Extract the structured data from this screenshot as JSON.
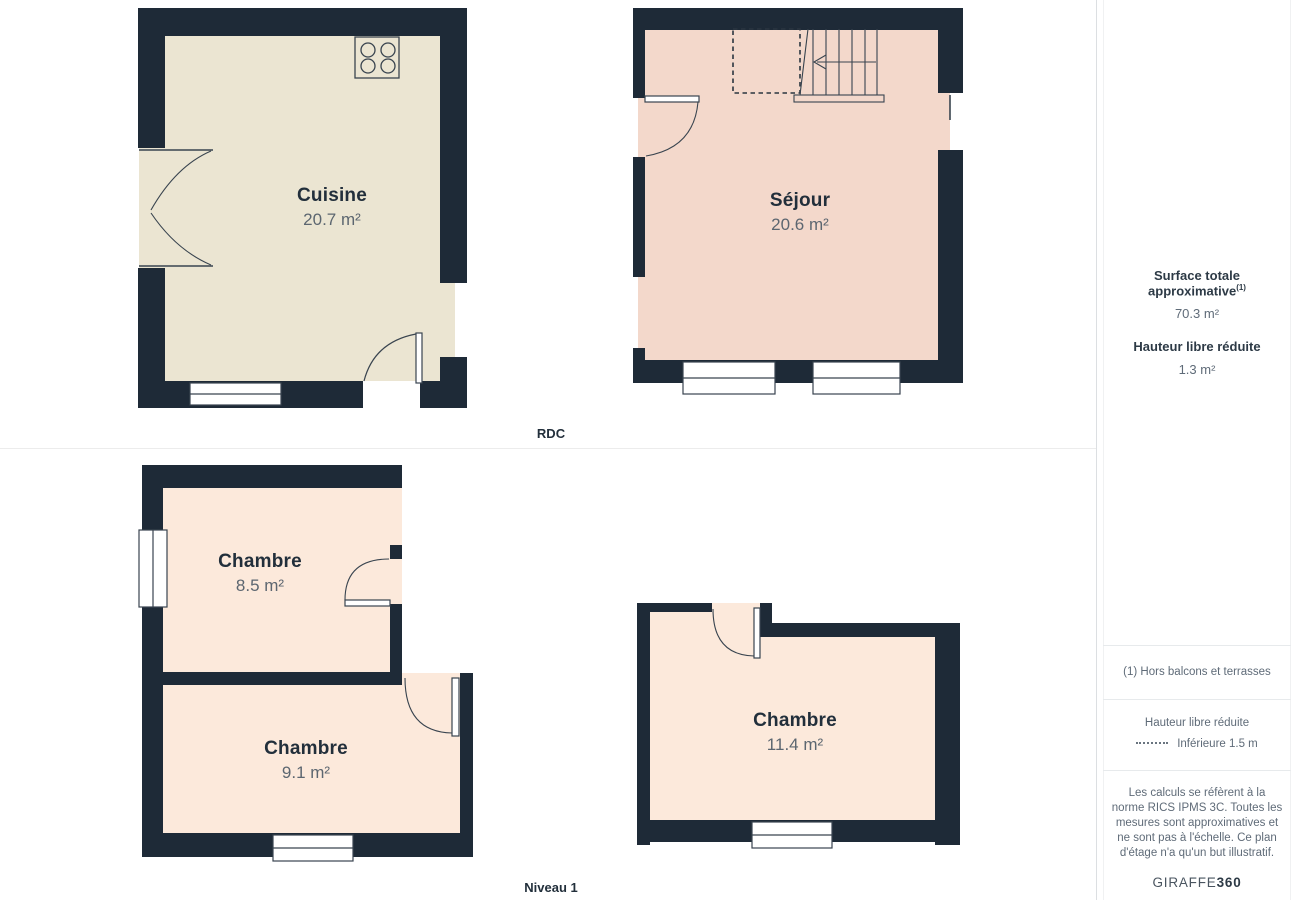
{
  "floors": {
    "rdc": {
      "label": "RDC",
      "rooms": [
        {
          "name": "Cuisine",
          "area": "20.7 m²"
        },
        {
          "name": "Séjour",
          "area": "20.6 m²"
        }
      ]
    },
    "niveau1": {
      "label": "Niveau 1",
      "rooms": [
        {
          "name": "Chambre",
          "area": "8.5 m²"
        },
        {
          "name": "Chambre",
          "area": "9.1 m²"
        },
        {
          "name": "Chambre",
          "area": "11.4 m²"
        }
      ]
    }
  },
  "sidebar": {
    "surface_title": "Surface totale approximative",
    "surface_title_sup": "(1)",
    "surface_value": "70.3 m²",
    "headroom_title": "Hauteur libre réduite",
    "headroom_value": "1.3 m²",
    "footnote": "(1) Hors balcons et terrasses",
    "legend_title": "Hauteur libre réduite",
    "legend_value": "Inférieure 1.5 m",
    "disclaimer": "Les calculs se réfèrent à la norme RICS IPMS 3C. Toutes les mesures sont approximatives et ne sont pas à l'échelle. Ce plan d'étage n'a qu'un but illustratif.",
    "brand": "GIRAFFE",
    "brand_suffix": "360"
  },
  "colors": {
    "wall": "#1e2a37",
    "floor_cuisine": "#ebe5d2",
    "floor_sejour": "#f3d8cb",
    "floor_chambre": "#fce9db",
    "line": "#39444f",
    "text_dark": "#222f3b",
    "text_gray": "#5f6b78"
  }
}
